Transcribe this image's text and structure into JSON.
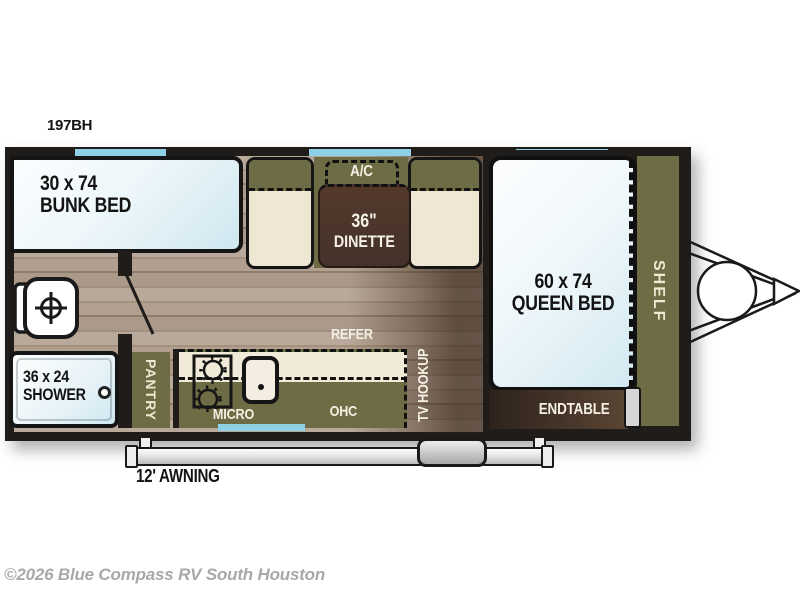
{
  "model": "197BH",
  "footer": "©2026 Blue Compass RV South Houston",
  "colors": {
    "olive_cabinet": "#6d6c44",
    "window_blue": "#8ed1e6",
    "table_brown": "#4a3529",
    "wall_black": "#1f1c1a",
    "bench_cream": "#efe6d4",
    "mattress_blue_white": "#d2e8f1",
    "floor_taupe": "#ab9a8a",
    "copyright_gray": "#a8a8a8"
  },
  "labels": {
    "bunk_size": "30 x 74",
    "bunk_name": "BUNK BED",
    "ac": "A/C",
    "dinette_size": "36\"",
    "dinette_name": "DINETTE",
    "queen_size": "60 x 74",
    "queen_name": "QUEEN BED",
    "shelf": "SHELF",
    "endtable": "ENDTABLE",
    "refer": "REFER",
    "tv_hookup": "TV HOOKUP",
    "micro": "MICRO",
    "ohc": "OHC",
    "pantry": "PANTRY",
    "shower_size": "36 x 24",
    "shower_name": "SHOWER",
    "awning": "12' AWNING"
  }
}
